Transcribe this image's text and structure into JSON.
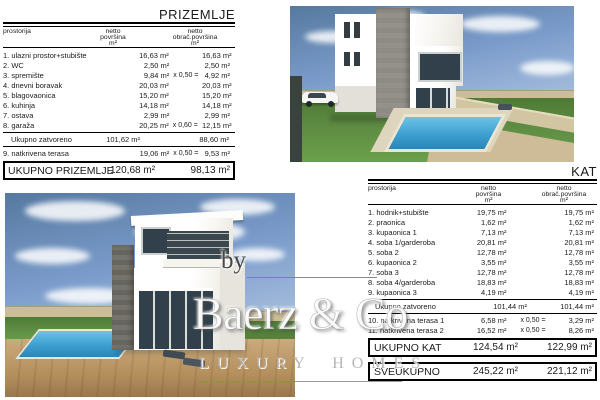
{
  "watermark": {
    "by": "by",
    "brand": "Baerz & Co",
    "tagline": "LUXURY HOMES"
  },
  "ground_floor": {
    "title": "PRIZEMLJE",
    "columns": {
      "room": "prostorija",
      "area": [
        "netto",
        "površina",
        "m²"
      ],
      "calc": [
        "netto",
        "obrač.površina",
        "m²"
      ]
    },
    "rows": [
      {
        "name": "1. ulazni prostor+stubište",
        "v1": "16,63 m²",
        "factor": "",
        "v2": "16,63 m²"
      },
      {
        "name": "2. WC",
        "v1": "2,50 m²",
        "factor": "",
        "v2": "2,50 m²"
      },
      {
        "name": "3. spremište",
        "v1": "9,84 m²",
        "factor": "x 0,50 =",
        "v2": "4,92 m²"
      },
      {
        "name": "4. dnevni boravak",
        "v1": "20,03 m²",
        "factor": "",
        "v2": "20,03 m²"
      },
      {
        "name": "5. blagovaonica",
        "v1": "15,20 m²",
        "factor": "",
        "v2": "15,20 m²"
      },
      {
        "name": "6. kuhinja",
        "v1": "14,18 m²",
        "factor": "",
        "v2": "14,18 m²"
      },
      {
        "name": "7. ostava",
        "v1": "2,99 m²",
        "factor": "",
        "v2": "2,99 m²"
      },
      {
        "name": "8. garaža",
        "v1": "20,25 m²",
        "factor": "x 0,60 =",
        "v2": "12,15 m²"
      }
    ],
    "subtotal": {
      "label": "Ukupno zatvoreno",
      "v1": "101,62 m²",
      "v2": "88,60 m²"
    },
    "terrace": {
      "name": "9. natkrivena terasa",
      "v1": "19,06 m²",
      "factor": "x 0,50 =",
      "v2": "9,53 m²"
    },
    "total": {
      "label": "UKUPNO PRIZEMLJE",
      "v1": "120,68 m²",
      "v2": "98,13 m²"
    }
  },
  "first_floor": {
    "title": "KAT",
    "columns": {
      "room": "prostorija",
      "area": [
        "netto",
        "površina",
        "m²"
      ],
      "calc": [
        "netto",
        "obrač.površina",
        "m²"
      ]
    },
    "rows": [
      {
        "name": "1. hodnik+stubište",
        "v1": "19,75 m²",
        "factor": "",
        "v2": "19,75 m²"
      },
      {
        "name": "2. praonica",
        "v1": "1,62 m²",
        "factor": "",
        "v2": "1,62 m²"
      },
      {
        "name": "3. kupaonica 1",
        "v1": "7,13 m²",
        "factor": "",
        "v2": "7,13 m²"
      },
      {
        "name": "4. soba 1/garderoba",
        "v1": "20,81 m²",
        "factor": "",
        "v2": "20,81 m²"
      },
      {
        "name": "5. soba 2",
        "v1": "12,78 m²",
        "factor": "",
        "v2": "12,78 m²"
      },
      {
        "name": "6. kupaonica 2",
        "v1": "3,55 m²",
        "factor": "",
        "v2": "3,55 m²"
      },
      {
        "name": "7. soba 3",
        "v1": "12,78 m²",
        "factor": "",
        "v2": "12,78 m²"
      },
      {
        "name": "8. soba 4/garderoba",
        "v1": "18,83 m²",
        "factor": "",
        "v2": "18,83 m²"
      },
      {
        "name": "9. kupaonica 3",
        "v1": "4,19 m²",
        "factor": "",
        "v2": "4,19 m²"
      }
    ],
    "subtotal": {
      "label": "Ukupno zatvoreno",
      "v1": "101,44 m²",
      "v2": "101,44 m²"
    },
    "terrace_rows": [
      {
        "name": "10. natkrivena terasa 1",
        "v1": "6,58 m²",
        "factor": "x 0,50 =",
        "v2": "3,29 m²"
      },
      {
        "name": "11. natkrivena terasa 2",
        "v1": "16,52 m²",
        "factor": "x 0,50 =",
        "v2": "8,26 m²"
      }
    ],
    "total": {
      "label": "UKUPNO KAT",
      "v1": "124,54 m²",
      "v2": "122,99 m²"
    },
    "grand_total": {
      "label": "SVEUKUPNO",
      "v1": "245,22 m²",
      "v2": "221,12 m²"
    }
  },
  "colors": {
    "sky": "#7b9ccb",
    "grass": "#5d8a42",
    "pool": "#3d9fd1",
    "stone_wall": "#cbbd96",
    "facade": "#f7f5f0",
    "stone_cladding": "#8d8b83",
    "window_glass": "#31404a",
    "deck_wood": "#b5905e",
    "table_ink": "#1b1b1b",
    "watermark_gray": "#b5b5b5"
  }
}
